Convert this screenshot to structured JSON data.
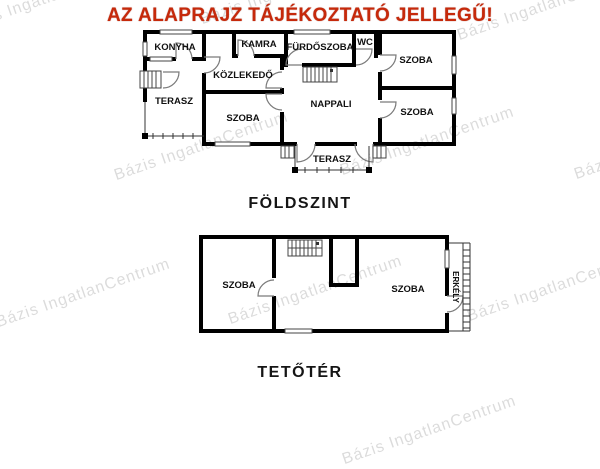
{
  "title": "AZ ALAPRAJZ TÁJÉKOZTATÓ JELLEGŰ!",
  "watermark": {
    "text": "Bázis IngatlanCentrum"
  },
  "ground_floor": {
    "label": "FÖLDSZINT",
    "rooms": {
      "konyha": "KONYHA",
      "kamra": "KAMRA",
      "furdoszoba": "FÜRDŐSZOBA",
      "wc": "WC",
      "szoba_jobb_felso": "SZOBA",
      "kozlekedo": "KÖZLEKEDŐ",
      "nappali": "NAPPALI",
      "szoba_kozep": "SZOBA",
      "szoba_jobb_also": "SZOBA",
      "terasz_bal": "TERASZ",
      "terasz_also": "TERASZ"
    }
  },
  "attic": {
    "label": "TETŐTÉR",
    "rooms": {
      "szoba_bal": "SZOBA",
      "szoba_jobb": "SZOBA",
      "erkely": "ERKÉLY"
    }
  },
  "colors": {
    "title_red": "#c6290b",
    "walls": "#000000",
    "watermark_gray": "#d9d9d9"
  }
}
